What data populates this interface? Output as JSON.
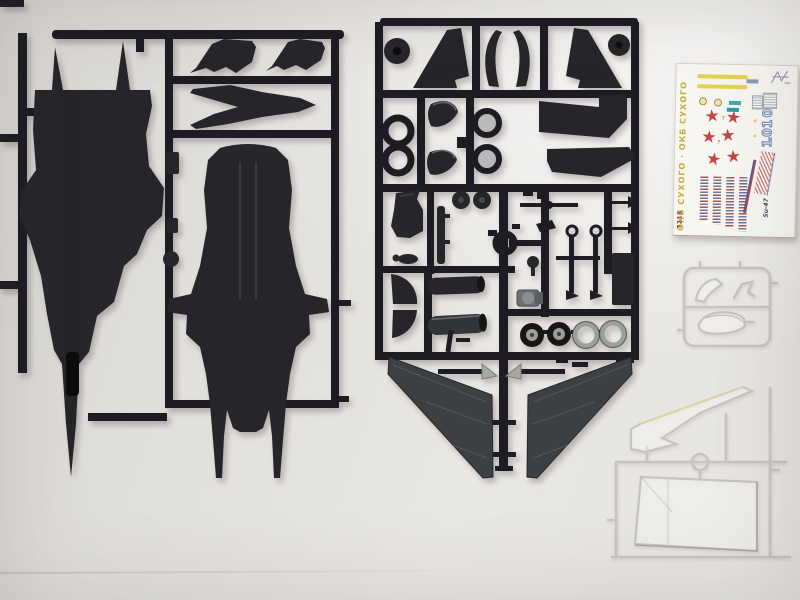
{
  "colors": {
    "plastic": "#1e1e21",
    "plastic2": "#26262a",
    "wing": "#3d4043",
    "paper": "#f7f6f1",
    "star_red": "#c64545",
    "stripe_yellow": "#e6d150",
    "numeral_blue": "#7e95c4",
    "teal": "#3fa9ad",
    "stripe_red": "#b84848",
    "stripe_blue": "#4a5fa5",
    "maker_yellow": "#c2ae3c",
    "clear_line": "#c6c4be",
    "metal_gray": "#9aa09a"
  },
  "decal": {
    "maker_text": "ОКБ СУХОГО · ОКБ СУХОГО",
    "kit_number": "7215",
    "aircraft_code": "Su-47",
    "tactical_numbers": [
      "10",
      "10"
    ],
    "star_glyph": "★",
    "star_count": 6,
    "footnote_mark": "7",
    "stencil_column_count": 4
  },
  "sprues": {
    "left_sprue": {
      "name": "fuselage-sprue",
      "parts": [
        "upper-fuselage-half",
        "lower-fuselage-half",
        "nose-cone",
        "canard-left",
        "canard-right",
        "small-fittings"
      ]
    },
    "right_sprue": {
      "name": "detail-parts-sprue",
      "parts": [
        "vertical-fin-left",
        "vertical-fin-right",
        "intake-lips",
        "exhaust-rings",
        "ejection-seat",
        "pilot-figure",
        "cockpit-rail",
        "landing-gear-struts",
        "engine-nozzles",
        "main-wheels",
        "wheel-rings",
        "equipment-panel",
        "missile-rails",
        "forward-swept-wing-left",
        "forward-swept-wing-right"
      ]
    },
    "clear_sprue": {
      "name": "clear-parts-sprue",
      "parts": [
        "windscreen",
        "canopy",
        "light-cover"
      ]
    },
    "stand_sprue": {
      "name": "display-stand-sprue",
      "parts": [
        "stand-arm",
        "stand-base"
      ]
    }
  }
}
